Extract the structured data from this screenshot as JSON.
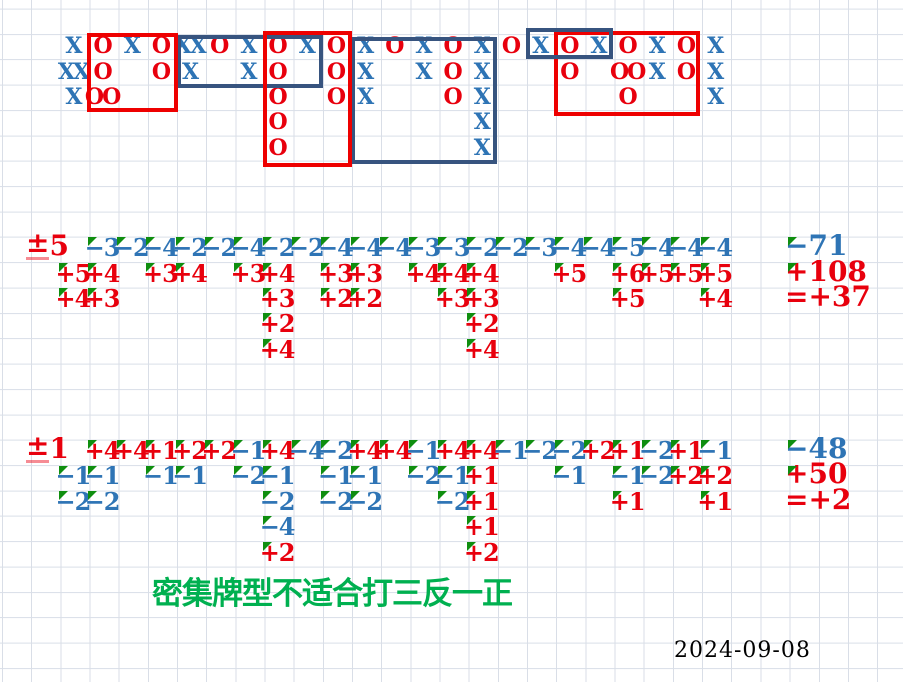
{
  "meta": {
    "date_label": "2024-09-08"
  },
  "note": {
    "text": "密集牌型不适合打三反一正"
  },
  "colors": {
    "blue_text": "#2E74B5",
    "red_text": "#E8000D",
    "box_red": "#EE0000",
    "box_blue": "#37547F",
    "grid_line": "#D9DEE7",
    "mark_green": "#0F8E0F",
    "note_green": "#00B050",
    "date_black": "#000000"
  },
  "grid": {
    "width": 903,
    "height": 682,
    "col_width": 29.17,
    "row_height": 25.36,
    "row_offset": 8.6
  },
  "xo_board": {
    "cells": [
      [
        2,
        3,
        "X"
      ],
      [
        2,
        4,
        "O"
      ],
      [
        2,
        5,
        "X"
      ],
      [
        2,
        6,
        "O"
      ],
      [
        2,
        7,
        "XX"
      ],
      [
        2,
        8,
        "O"
      ],
      [
        2,
        9,
        "X"
      ],
      [
        2,
        10,
        "O"
      ],
      [
        2,
        11,
        "X"
      ],
      [
        2,
        12,
        "O"
      ],
      [
        2,
        13,
        "X"
      ],
      [
        2,
        14,
        "O"
      ],
      [
        2,
        15,
        "X"
      ],
      [
        2,
        16,
        "O"
      ],
      [
        2,
        17,
        "X"
      ],
      [
        2,
        18,
        "O"
      ],
      [
        2,
        19,
        "X"
      ],
      [
        2,
        20,
        "O"
      ],
      [
        2,
        21,
        "X"
      ],
      [
        2,
        22,
        "O"
      ],
      [
        2,
        23,
        "X"
      ],
      [
        2,
        24,
        "O"
      ],
      [
        2,
        25,
        "X"
      ],
      [
        3,
        3,
        "XX"
      ],
      [
        3,
        4,
        "O"
      ],
      [
        3,
        6,
        "O"
      ],
      [
        3,
        7,
        "X"
      ],
      [
        3,
        9,
        "X"
      ],
      [
        3,
        10,
        "O"
      ],
      [
        3,
        12,
        "O"
      ],
      [
        3,
        13,
        "X"
      ],
      [
        3,
        15,
        "X"
      ],
      [
        3,
        16,
        "O"
      ],
      [
        3,
        17,
        "X"
      ],
      [
        3,
        20,
        "O"
      ],
      [
        3,
        22,
        "OO"
      ],
      [
        3,
        23,
        "X"
      ],
      [
        3,
        24,
        "O"
      ],
      [
        3,
        25,
        "X"
      ],
      [
        4,
        3,
        "X"
      ],
      [
        4,
        4,
        "OO"
      ],
      [
        4,
        10,
        "O"
      ],
      [
        4,
        12,
        "O"
      ],
      [
        4,
        13,
        "X"
      ],
      [
        4,
        16,
        "O"
      ],
      [
        4,
        17,
        "X"
      ],
      [
        4,
        22,
        "O"
      ],
      [
        4,
        25,
        "X"
      ],
      [
        5,
        10,
        "O"
      ],
      [
        5,
        17,
        "X"
      ],
      [
        6,
        10,
        "O"
      ],
      [
        6,
        17,
        "X"
      ]
    ]
  },
  "boxes": [
    {
      "name": "annotation-box-blue-1",
      "color": "blue",
      "x": 177,
      "y": 35,
      "w": 146,
      "h": 53
    },
    {
      "name": "annotation-box-blue-2",
      "color": "blue",
      "x": 351,
      "y": 37,
      "w": 146,
      "h": 127
    },
    {
      "name": "annotation-box-red-1",
      "color": "red",
      "x": 87,
      "y": 33,
      "w": 91,
      "h": 79
    },
    {
      "name": "annotation-box-red-2",
      "color": "red",
      "x": 263,
      "y": 31,
      "w": 89,
      "h": 136
    },
    {
      "name": "annotation-box-red-3",
      "color": "red",
      "x": 554,
      "y": 31,
      "w": 146,
      "h": 85
    },
    {
      "name": "annotation-box-blue-3",
      "color": "blue",
      "x": 526,
      "y": 28,
      "w": 87,
      "h": 31
    }
  ],
  "sections": [
    {
      "name": "plus-minus-5",
      "label": "±5",
      "label_row": 10,
      "cells": [
        [
          10,
          4,
          "−3",
          "b",
          1
        ],
        [
          10,
          5,
          "−2",
          "b",
          1
        ],
        [
          10,
          6,
          "−4",
          "b",
          1
        ],
        [
          10,
          7,
          "−2",
          "b",
          1
        ],
        [
          10,
          8,
          "−2",
          "b",
          1
        ],
        [
          10,
          9,
          "−4",
          "b",
          1
        ],
        [
          10,
          10,
          "−2",
          "b",
          1
        ],
        [
          10,
          11,
          "−2",
          "b",
          1
        ],
        [
          10,
          12,
          "−4",
          "b",
          1
        ],
        [
          10,
          13,
          "−4",
          "b",
          1
        ],
        [
          10,
          14,
          "−4",
          "b",
          1
        ],
        [
          10,
          15,
          "−3",
          "b",
          1
        ],
        [
          10,
          16,
          "−3",
          "b",
          1
        ],
        [
          10,
          17,
          "−2",
          "b",
          1
        ],
        [
          10,
          18,
          "−2",
          "b",
          1
        ],
        [
          10,
          19,
          "−3",
          "b",
          1
        ],
        [
          10,
          20,
          "−4",
          "b",
          1
        ],
        [
          10,
          21,
          "−4",
          "b",
          1
        ],
        [
          10,
          22,
          "−5",
          "b",
          1
        ],
        [
          10,
          23,
          "−4",
          "b",
          1
        ],
        [
          10,
          24,
          "−4",
          "b",
          1
        ],
        [
          10,
          25,
          "−4",
          "b",
          1
        ],
        [
          11,
          3,
          "+5",
          "r",
          1
        ],
        [
          11,
          4,
          "+4",
          "r",
          1
        ],
        [
          11,
          6,
          "+3",
          "r",
          1
        ],
        [
          11,
          7,
          "+4",
          "r",
          1
        ],
        [
          11,
          9,
          "+3",
          "r",
          1
        ],
        [
          11,
          10,
          "+4",
          "r",
          1
        ],
        [
          11,
          12,
          "+3",
          "r",
          1
        ],
        [
          11,
          13,
          "+3",
          "r",
          1
        ],
        [
          11,
          15,
          "+4",
          "r",
          1
        ],
        [
          11,
          16,
          "+4",
          "r",
          1
        ],
        [
          11,
          17,
          "+4",
          "r",
          1
        ],
        [
          11,
          20,
          "+5",
          "r",
          1
        ],
        [
          11,
          22,
          "+6",
          "r",
          1
        ],
        [
          11,
          23,
          "+5",
          "r",
          1
        ],
        [
          11,
          24,
          "+5",
          "r",
          1
        ],
        [
          11,
          25,
          "+5",
          "r",
          1
        ],
        [
          12,
          3,
          "+4",
          "r",
          1
        ],
        [
          12,
          4,
          "+3",
          "r",
          1
        ],
        [
          12,
          10,
          "+3",
          "r",
          1
        ],
        [
          12,
          12,
          "+2",
          "r",
          1
        ],
        [
          12,
          13,
          "+2",
          "r",
          1
        ],
        [
          12,
          16,
          "+3",
          "r",
          1
        ],
        [
          12,
          17,
          "+3",
          "r",
          1
        ],
        [
          12,
          22,
          "+5",
          "r",
          1
        ],
        [
          12,
          25,
          "+4",
          "r",
          1
        ],
        [
          13,
          10,
          "+2",
          "r",
          1
        ],
        [
          13,
          17,
          "+2",
          "r",
          1
        ],
        [
          14,
          10,
          "+4",
          "r",
          1
        ],
        [
          14,
          17,
          "+4",
          "r",
          1
        ]
      ],
      "sums": [
        [
          10,
          "−71",
          "b",
          1
        ],
        [
          11,
          "+108",
          "r",
          1
        ],
        [
          12,
          "=+37",
          "r",
          0
        ]
      ]
    },
    {
      "name": "plus-minus-1",
      "label": "±1",
      "label_row": 18,
      "cells": [
        [
          18,
          4,
          "+4",
          "r",
          1
        ],
        [
          18,
          5,
          "+4",
          "r",
          1
        ],
        [
          18,
          6,
          "+1",
          "r",
          1
        ],
        [
          18,
          7,
          "+2",
          "r",
          1
        ],
        [
          18,
          8,
          "+2",
          "r",
          1
        ],
        [
          18,
          9,
          "−1",
          "b",
          1
        ],
        [
          18,
          10,
          "+4",
          "r",
          1
        ],
        [
          18,
          11,
          "−4",
          "b",
          1
        ],
        [
          18,
          12,
          "−2",
          "b",
          1
        ],
        [
          18,
          13,
          "+4",
          "r",
          1
        ],
        [
          18,
          14,
          "+4",
          "r",
          1
        ],
        [
          18,
          15,
          "−1",
          "b",
          1
        ],
        [
          18,
          16,
          "+4",
          "r",
          1
        ],
        [
          18,
          17,
          "+4",
          "r",
          1
        ],
        [
          18,
          18,
          "−1",
          "b",
          1
        ],
        [
          18,
          19,
          "−2",
          "b",
          1
        ],
        [
          18,
          20,
          "−2",
          "b",
          1
        ],
        [
          18,
          21,
          "+2",
          "r",
          1
        ],
        [
          18,
          22,
          "+1",
          "r",
          1
        ],
        [
          18,
          23,
          "−2",
          "b",
          1
        ],
        [
          18,
          24,
          "+1",
          "r",
          1
        ],
        [
          18,
          25,
          "−1",
          "b",
          1
        ],
        [
          19,
          3,
          "−1",
          "b",
          1
        ],
        [
          19,
          4,
          "−1",
          "b",
          1
        ],
        [
          19,
          6,
          "−1",
          "b",
          1
        ],
        [
          19,
          7,
          "−1",
          "b",
          1
        ],
        [
          19,
          9,
          "−2",
          "b",
          1
        ],
        [
          19,
          10,
          "−1",
          "b",
          1
        ],
        [
          19,
          12,
          "−1",
          "b",
          1
        ],
        [
          19,
          13,
          "−1",
          "b",
          1
        ],
        [
          19,
          15,
          "−2",
          "b",
          1
        ],
        [
          19,
          16,
          "−1",
          "b",
          1
        ],
        [
          19,
          17,
          "+1",
          "r",
          1
        ],
        [
          19,
          20,
          "−1",
          "b",
          1
        ],
        [
          19,
          22,
          "−1",
          "b",
          1
        ],
        [
          19,
          23,
          "−2",
          "b",
          1
        ],
        [
          19,
          24,
          "+2",
          "r",
          1
        ],
        [
          19,
          25,
          "+2",
          "r",
          1
        ],
        [
          20,
          3,
          "−2",
          "b",
          1
        ],
        [
          20,
          4,
          "−2",
          "b",
          1
        ],
        [
          20,
          10,
          "−2",
          "b",
          1
        ],
        [
          20,
          12,
          "−2",
          "b",
          1
        ],
        [
          20,
          13,
          "−2",
          "b",
          1
        ],
        [
          20,
          16,
          "−2",
          "b",
          1
        ],
        [
          20,
          17,
          "+1",
          "r",
          1
        ],
        [
          20,
          22,
          "+1",
          "r",
          1
        ],
        [
          20,
          25,
          "+1",
          "r",
          1
        ],
        [
          21,
          10,
          "−4",
          "b",
          1
        ],
        [
          21,
          17,
          "+1",
          "r",
          1
        ],
        [
          22,
          10,
          "+2",
          "r",
          1
        ],
        [
          22,
          17,
          "+2",
          "r",
          1
        ]
      ],
      "sums": [
        [
          18,
          "−48",
          "b",
          1
        ],
        [
          19,
          "+50",
          "r",
          1
        ],
        [
          20,
          "=+2",
          "r",
          0
        ]
      ]
    }
  ]
}
